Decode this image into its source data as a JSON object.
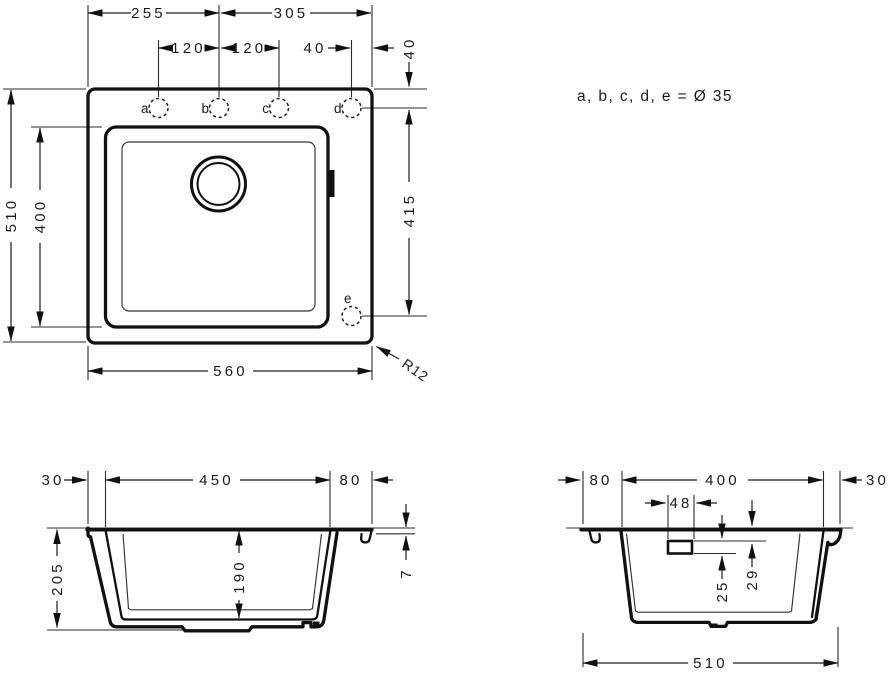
{
  "note": "a, b, c, d, e = Ø 35",
  "top_view": {
    "dim_edge_to_b": "255",
    "dim_b_to_edge": "305",
    "dim_a_b": "120",
    "dim_b_c": "120",
    "dim_d_to_edge": "40",
    "dim_edge_to_holes": "40",
    "dim_total_depth": "510",
    "dim_bowl_depth": "400",
    "dim_d_to_e": "415",
    "dim_total_width": "560",
    "corner_radius": "R12",
    "holes": {
      "a": "a",
      "b": "b",
      "c": "c",
      "d": "d",
      "e": "e"
    }
  },
  "front_section": {
    "dim_left_rim": "30",
    "dim_bowl_width": "450",
    "dim_right_rim": "80",
    "dim_total_height": "205",
    "dim_bowl_inner_depth": "190",
    "dim_rim_thickness": "7"
  },
  "side_section": {
    "dim_back_rim": "80",
    "dim_bowl_length": "400",
    "dim_front_rim": "30",
    "dim_overflow_width": "48",
    "dim_overflow_height": "25",
    "dim_overflow_offset": "29",
    "dim_total_depth": "510"
  }
}
